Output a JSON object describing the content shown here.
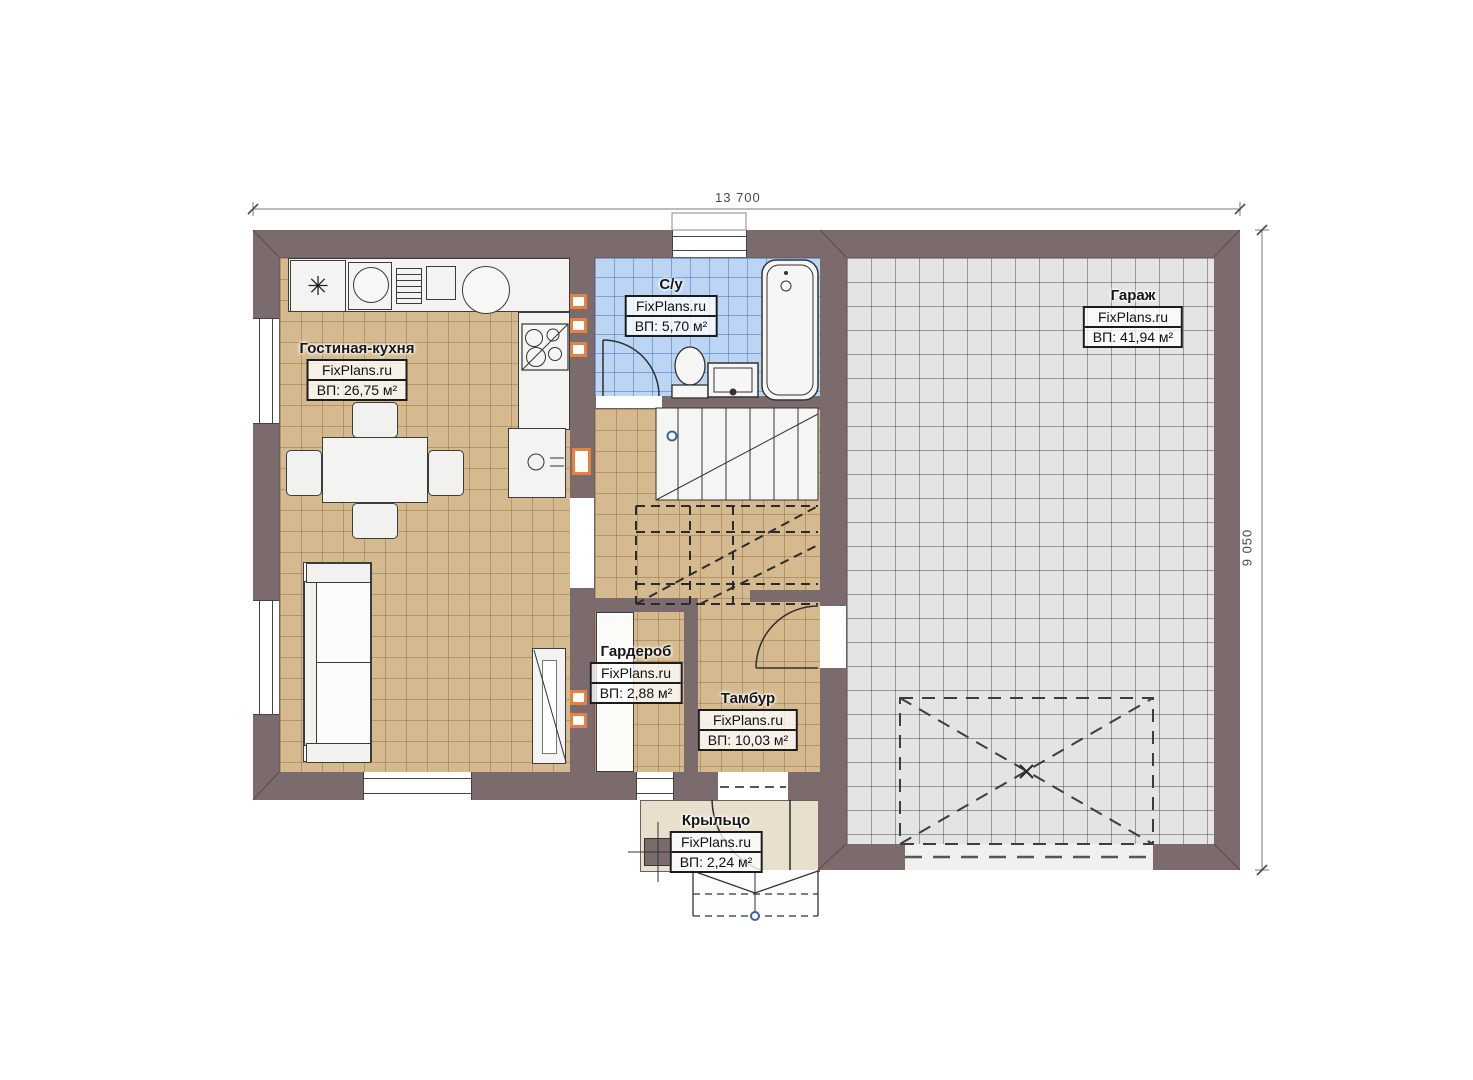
{
  "dimensions": {
    "width": "13 700",
    "height": "9 050"
  },
  "rooms": {
    "living": {
      "name": "Гостиная-кухня",
      "brand": "FixPlans.ru",
      "area": "ВП: 26,75 м²"
    },
    "bathroom": {
      "name": "С/у",
      "brand": "FixPlans.ru",
      "area": "ВП: 5,70 м²"
    },
    "garage": {
      "name": "Гараж",
      "brand": "FixPlans.ru",
      "area": "ВП: 41,94 м²"
    },
    "wardrobe": {
      "name": "Гардероб",
      "brand": "FixPlans.ru",
      "area": "ВП: 2,88 м²"
    },
    "vestibule": {
      "name": "Тамбур",
      "brand": "FixPlans.ru",
      "area": "ВП: 10,03 м²"
    },
    "porch": {
      "name": "Крыльцо",
      "brand": "FixPlans.ru",
      "area": "ВП: 2,24 м²"
    }
  },
  "symbols": {
    "refrigerator": "✳"
  },
  "colors": {
    "wall": "#7c6b6d",
    "floor_wood": "#d5ba90",
    "floor_bath": "#bcd5f2",
    "floor_garage": "#e4e4e2",
    "floor_porch": "#e9dfcd",
    "accent_orange": "#e8803f"
  }
}
